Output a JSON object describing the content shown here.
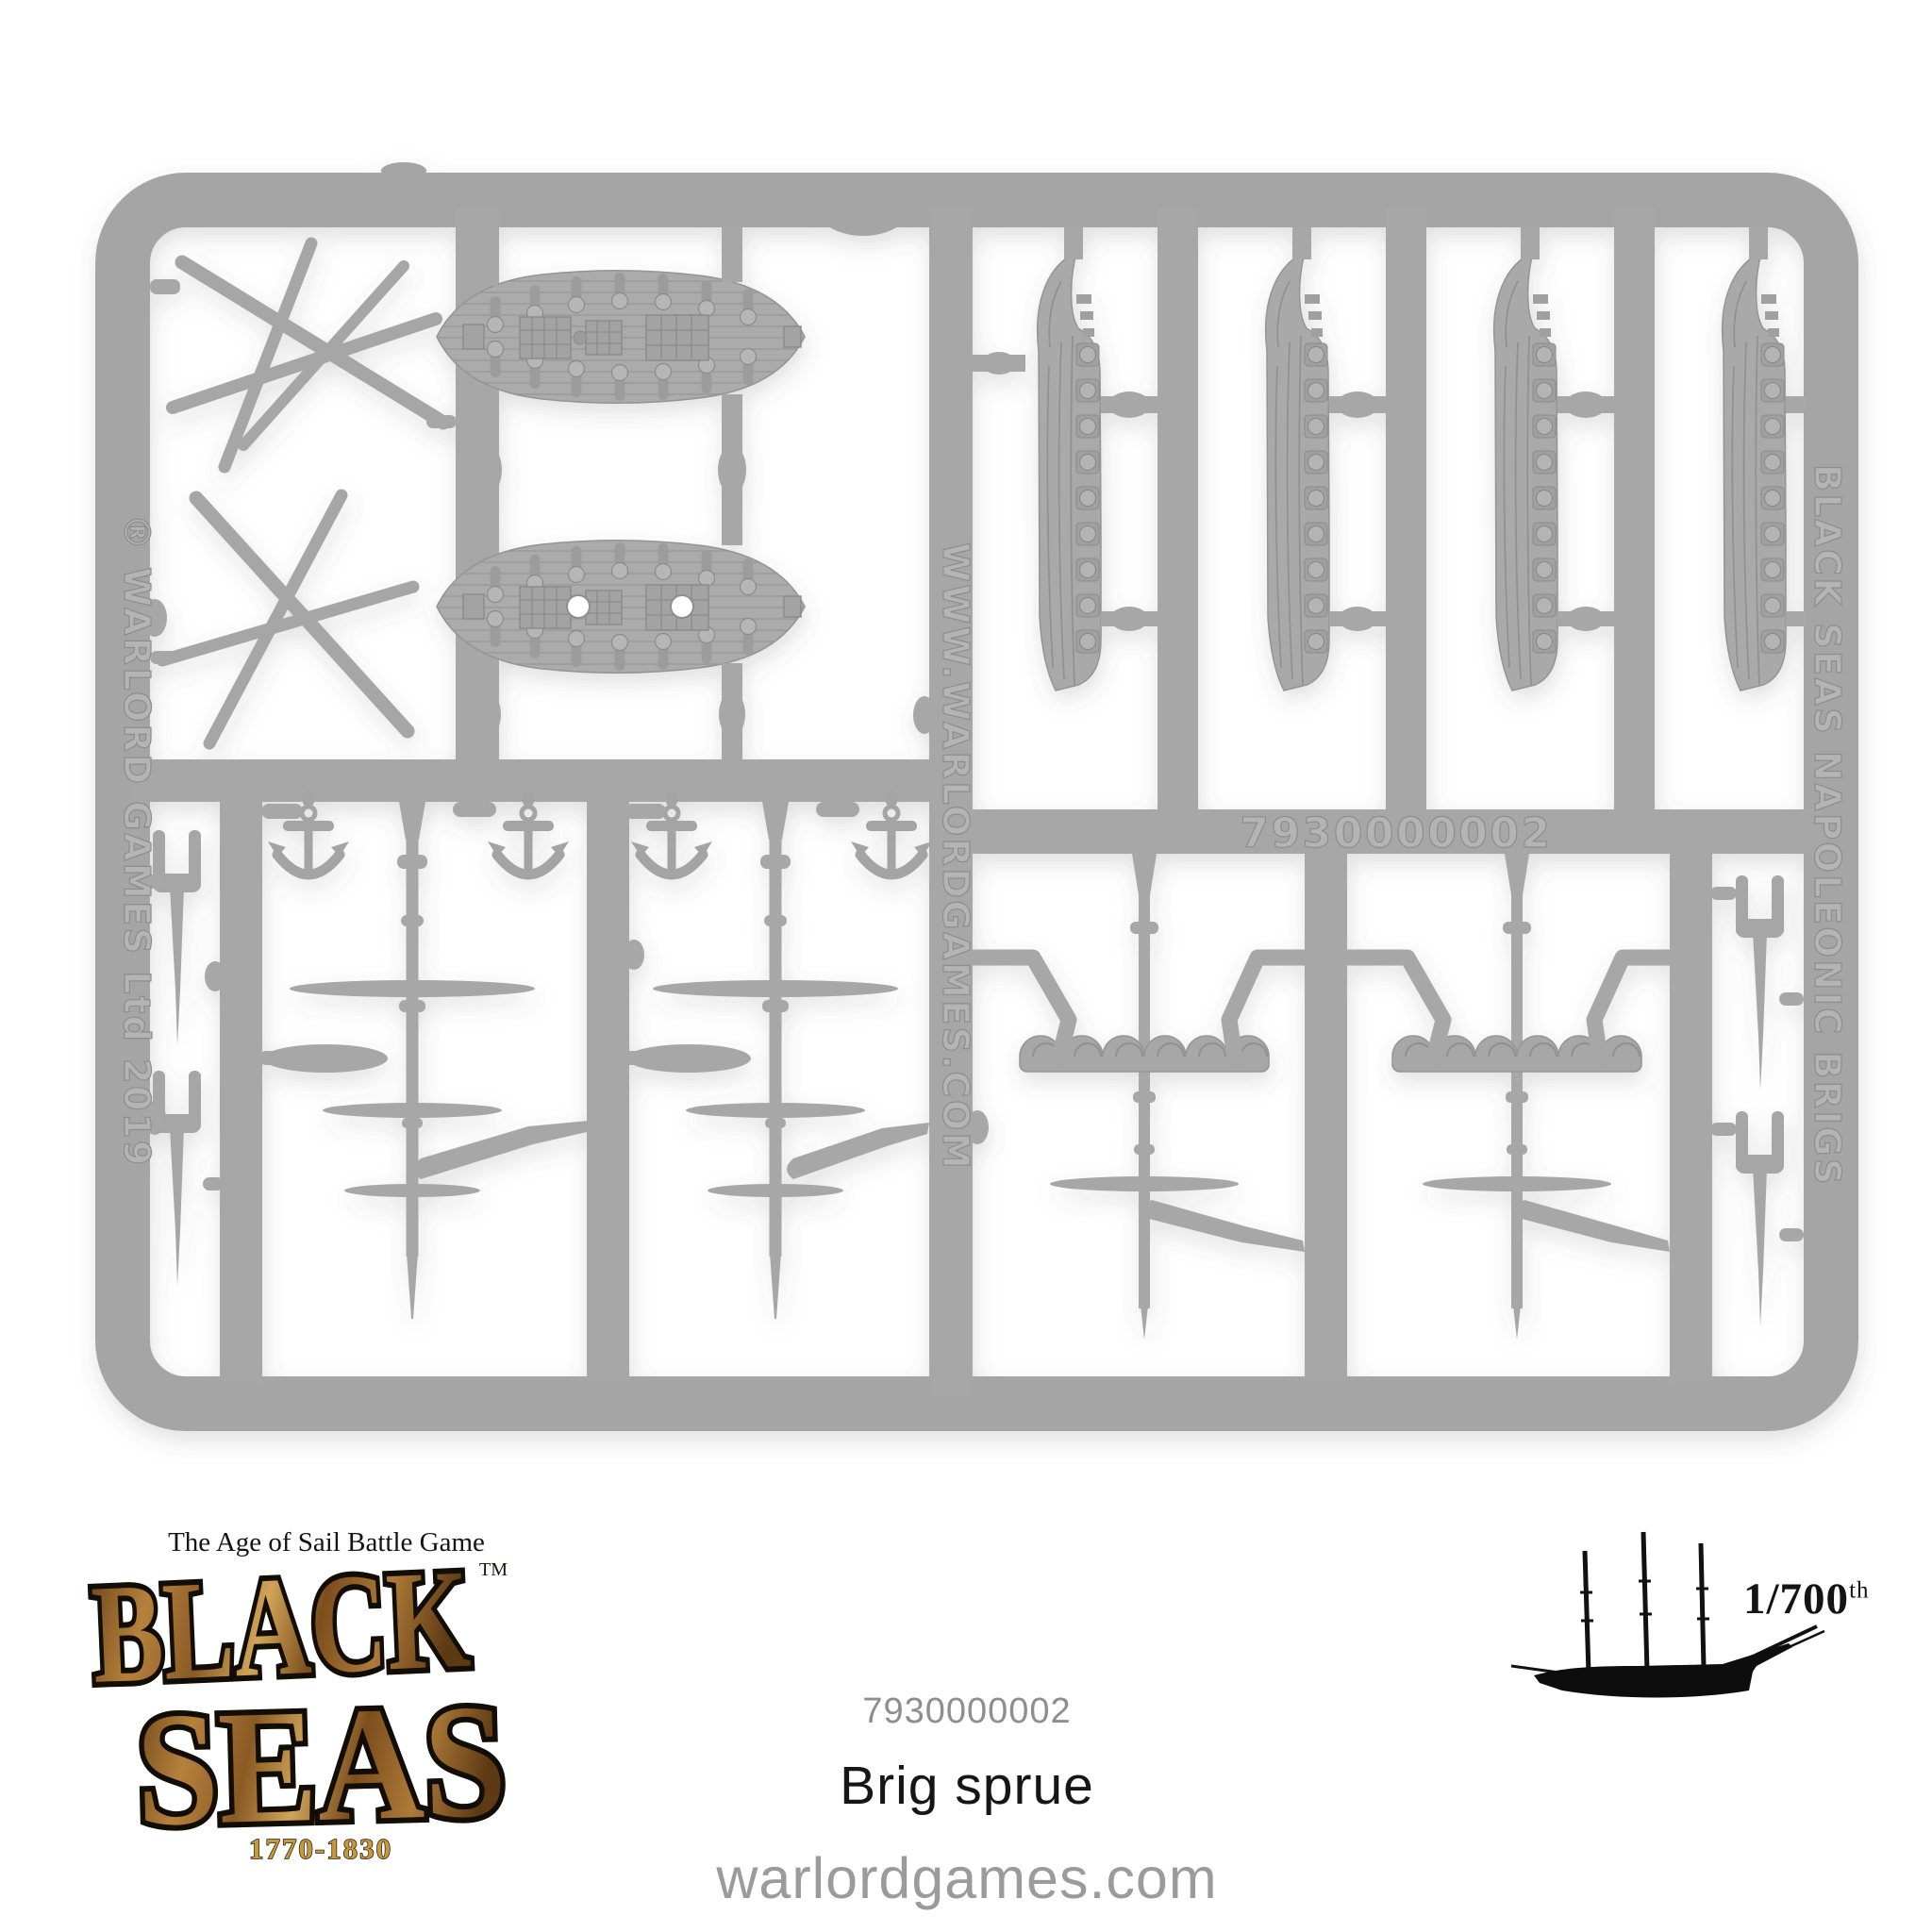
{
  "sprue": {
    "plastic_color": "#a7a7a7",
    "mold_texts": {
      "left_vertical": "® WARLORD GAMES Ltd 2019",
      "center_vertical": "WWW.WARLORDGAMES.COM",
      "right_vertical": "BLACK SEAS NAPOLEONIC BRIGS",
      "part_number": "7930000002"
    }
  },
  "logo": {
    "tagline": "The Age of Sail Battle Game",
    "title_top": "BLACK",
    "title_bottom": "SEAS",
    "trademark": "TM",
    "years": "1770-1830",
    "wood_color": "#a5752f",
    "gold_color": "#c9993e"
  },
  "scale_badge": {
    "fraction": "1/700",
    "ordinal": "th"
  },
  "product": {
    "sku": "7930000002",
    "title": "Brig sprue",
    "website": "warlordgames.com"
  }
}
